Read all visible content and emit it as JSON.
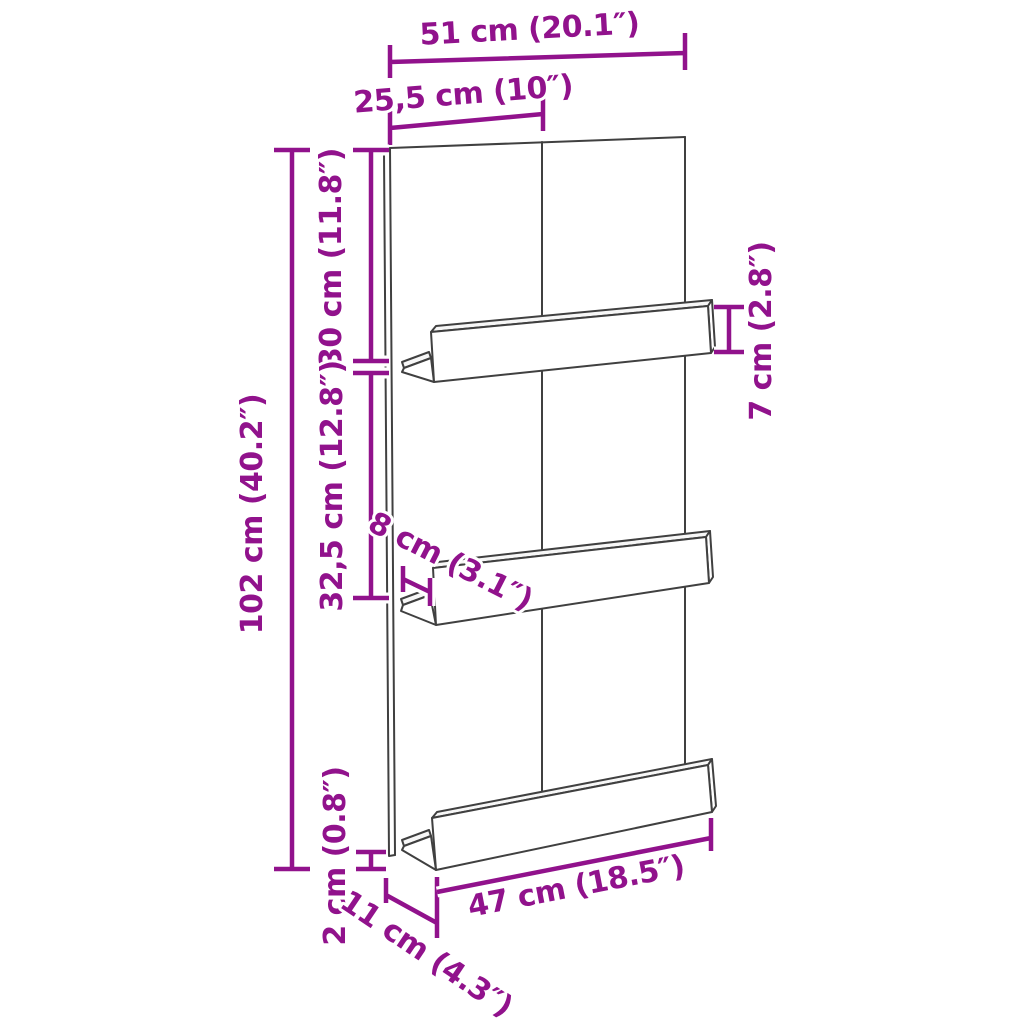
{
  "diagram": {
    "colors": {
      "dimension": "#91128C",
      "outline": "#404040",
      "background": "#FFFFFF"
    },
    "dimensions": {
      "total_width": "51 cm (20.1″)",
      "half_width": "25,5 cm (10″)",
      "top_to_first_shelf": "30 cm (11.8″)",
      "shelf_spacing": "32,5 cm (12.8″)",
      "total_height": "102 cm (40.2″)",
      "ledge_height": "7 cm (2.8″)",
      "shelf_depth_middle": "8 cm (3.1″)",
      "panel_thickness": "2 cm (0.8″)",
      "shelf_depth_bottom": "11 cm (4.3″)",
      "shelf_length": "47 cm (18.5″)"
    }
  }
}
